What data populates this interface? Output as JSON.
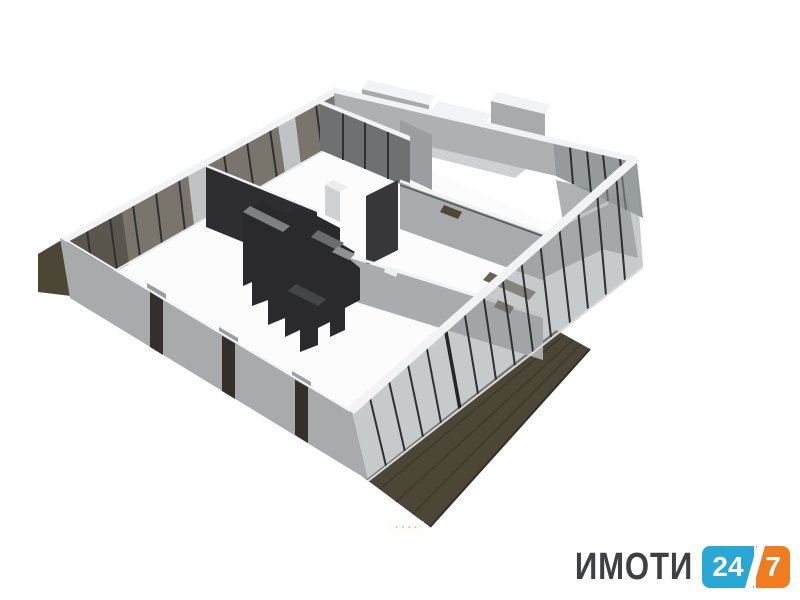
{
  "page": {
    "background": "#ffffff"
  },
  "scene": {
    "description": "3D isometric architectural floor plan render of an apartment with glass exterior walls, dark interior core and two brown terrace decks",
    "parts": [
      "left-terrace-deck",
      "right-terrace-deck",
      "floor-slab",
      "northwest-glass-wall",
      "southwest-solid-wall",
      "southeast-glass-wall",
      "northeast-wall-with-protruding-rooms",
      "corner-glass-room",
      "dark-interior-partition",
      "interior-glass-partition",
      "dark-core-kitchen-block",
      "interior-partitions",
      "column"
    ]
  },
  "branding": {
    "name_text": "ИМОТИ",
    "badge_left": "24",
    "badge_right": "7"
  },
  "watermark_small": {
    "marks": "- - - -"
  },
  "colors": {
    "white": "#ffffff",
    "cap_white": "#f2f3f4",
    "wall_light": "#aeb0b2",
    "wall_mid": "#a8aaac",
    "wall_gray": "#9b9da0",
    "glass_brown": "#79756c",
    "glass_brown_dark": "#5a564e",
    "glass_gray": "#9aa0a2",
    "glass_gray_dark": "#83898b",
    "mullion_dark": "#2e3032",
    "partition_dark": "#2e2e30",
    "core_dark": "#2a2a2c",
    "core_gray": "#7e8082",
    "deck_brown": "#4c4637",
    "deck_stripe": "#3e392c",
    "lintel_brown": "#4f4736",
    "floor_white": "#fcfcfd",
    "floor_gray": "#9b9d9f",
    "logo_text": "#3f4041",
    "logo_blue": "#2aa8d5",
    "logo_orange": "#ef7d20",
    "mini_orange": "#e2862c"
  }
}
